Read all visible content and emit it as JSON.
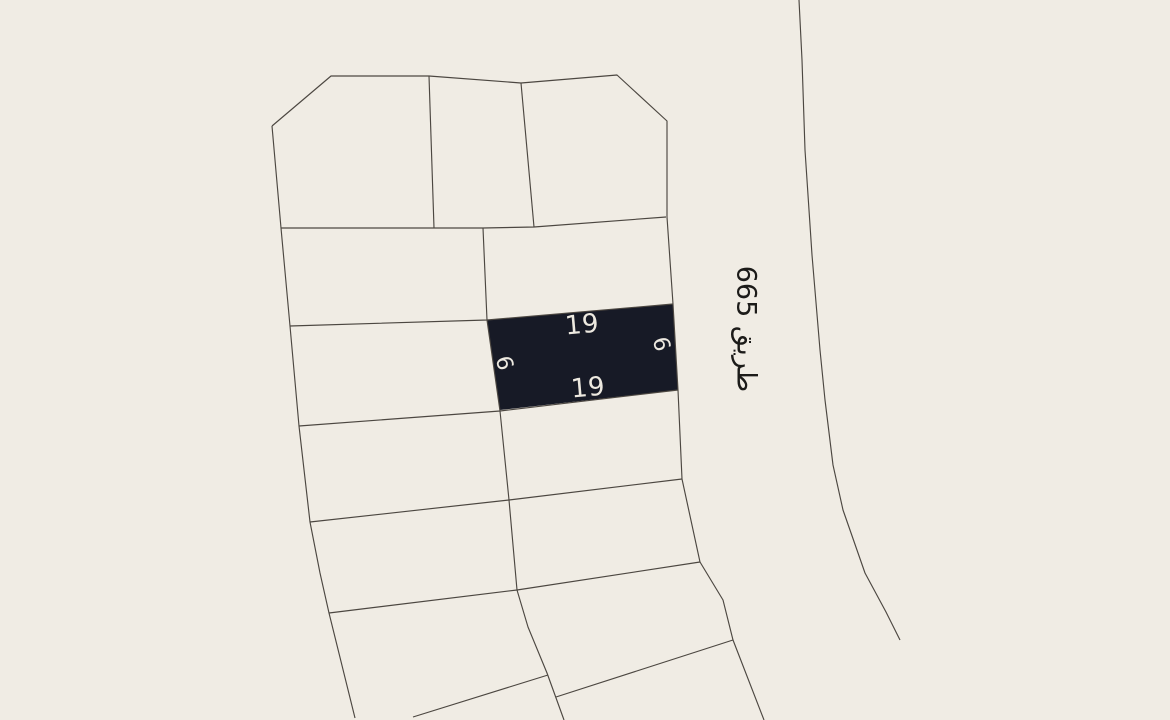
{
  "map": {
    "width": 1170,
    "height": 720,
    "background_color": "#F0ECE4",
    "boundary_color": "#4C4741",
    "boundary_width": 1.15,
    "selected_parcel": {
      "fill": "#171A26",
      "label_color": "#EDE9E0",
      "polygon": [
        [
          487,
          320
        ],
        [
          673,
          304
        ],
        [
          678,
          390
        ],
        [
          500,
          410
        ]
      ]
    },
    "labels": {
      "dim_top": {
        "text": "19",
        "x": 582,
        "y": 325,
        "rotate": -5,
        "size": 26,
        "color": "#EDE9E0"
      },
      "dim_bottom": {
        "text": "19",
        "x": 588,
        "y": 388,
        "rotate": -5,
        "size": 26,
        "color": "#EDE9E0"
      },
      "dim_left": {
        "text": "9",
        "x": 507,
        "y": 362,
        "rotate": -105,
        "size": 22,
        "color": "#EDE9E0"
      },
      "dim_right": {
        "text": "9",
        "x": 664,
        "y": 343,
        "rotate": -105,
        "size": 22,
        "color": "#EDE9E0"
      },
      "road": {
        "text": "طريق 665",
        "x": 746,
        "y": 329,
        "rotate": 90,
        "size": 27,
        "color": "#1C1B19"
      }
    },
    "parcel_boundaries": [
      {
        "name": "top-block-outline-top",
        "points": [
          [
            272,
            126
          ],
          [
            331,
            76
          ],
          [
            429,
            76
          ],
          [
            521,
            83
          ],
          [
            617,
            75
          ],
          [
            667,
            121
          ],
          [
            667,
            217
          ]
        ]
      },
      {
        "name": "block-left-edge",
        "points": [
          [
            272,
            126
          ],
          [
            281,
            228
          ],
          [
            290,
            326
          ],
          [
            299,
            426
          ],
          [
            310,
            522
          ],
          [
            320,
            573
          ],
          [
            329,
            613
          ],
          [
            355,
            718
          ]
        ]
      },
      {
        "name": "top-block-bottom-edge",
        "points": [
          [
            281,
            228
          ],
          [
            483,
            228
          ],
          [
            534,
            227
          ],
          [
            666,
            217
          ]
        ]
      },
      {
        "name": "top-block-divider-1",
        "points": [
          [
            429,
            76
          ],
          [
            434,
            228
          ]
        ]
      },
      {
        "name": "top-block-divider-2",
        "points": [
          [
            521,
            83
          ],
          [
            534,
            227
          ]
        ]
      },
      {
        "name": "center-column-divider",
        "points": [
          [
            483,
            228
          ],
          [
            487,
            320
          ],
          [
            500,
            411
          ],
          [
            509,
            500
          ],
          [
            517,
            590
          ],
          [
            528,
            627
          ],
          [
            547,
            673
          ],
          [
            564,
            720
          ]
        ]
      },
      {
        "name": "block-right-edge",
        "points": [
          [
            667,
            217
          ],
          [
            673,
            304
          ],
          [
            678,
            390
          ],
          [
            682,
            479
          ],
          [
            700,
            562
          ],
          [
            723,
            600
          ],
          [
            733,
            640
          ],
          [
            764,
            720
          ]
        ]
      },
      {
        "name": "row-divider-1",
        "points": [
          [
            290,
            326
          ],
          [
            487,
            320
          ],
          [
            673,
            304
          ]
        ]
      },
      {
        "name": "row-divider-2",
        "points": [
          [
            299,
            426
          ],
          [
            500,
            411
          ],
          [
            678,
            390
          ]
        ]
      },
      {
        "name": "row-divider-3",
        "points": [
          [
            310,
            522
          ],
          [
            509,
            500
          ],
          [
            682,
            479
          ]
        ]
      },
      {
        "name": "row-divider-4",
        "points": [
          [
            329,
            613
          ],
          [
            517,
            590
          ],
          [
            700,
            562
          ]
        ]
      },
      {
        "name": "row-divider-5-right",
        "points": [
          [
            556,
            697
          ],
          [
            733,
            640
          ]
        ]
      },
      {
        "name": "row-divider-5-left",
        "points": [
          [
            413,
            717
          ],
          [
            548,
            675
          ]
        ]
      }
    ],
    "road_line": {
      "name": "road-edge-line",
      "points": [
        [
          799,
          0
        ],
        [
          802,
          60
        ],
        [
          805,
          150
        ],
        [
          812,
          255
        ],
        [
          820,
          350
        ],
        [
          825,
          400
        ],
        [
          833,
          465
        ],
        [
          843,
          510
        ],
        [
          865,
          573
        ],
        [
          886,
          612
        ],
        [
          900,
          640
        ]
      ]
    }
  }
}
